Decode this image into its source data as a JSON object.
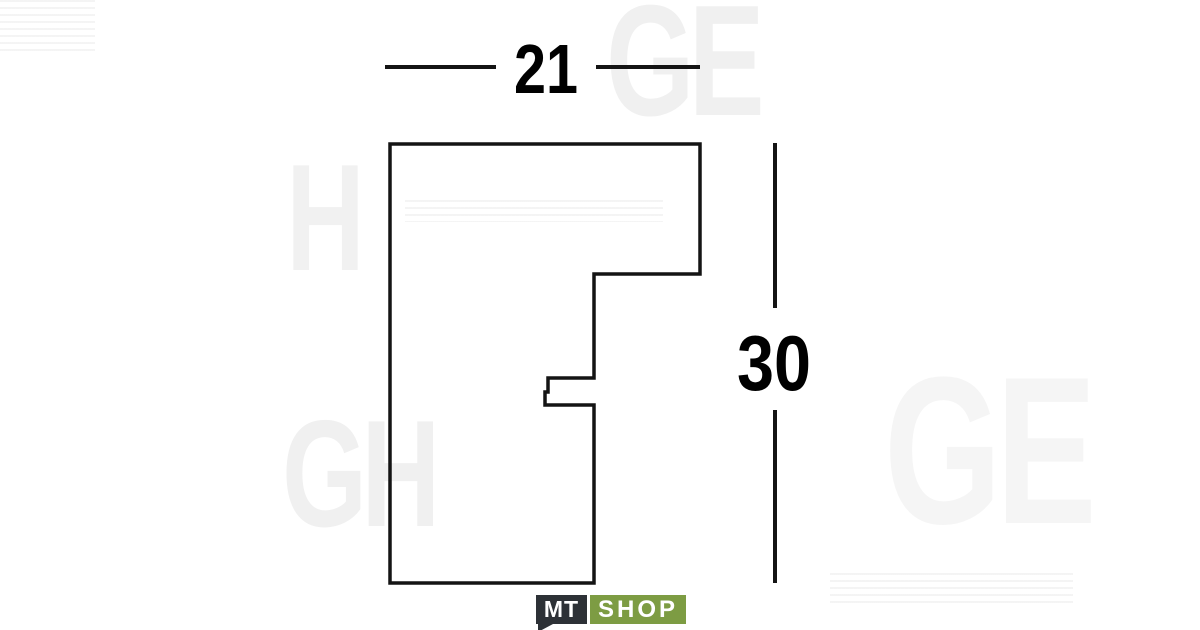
{
  "diagram": {
    "width_label": "21",
    "height_label": "30",
    "outline_color": "#141414",
    "profile_points": [
      [
        390,
        144
      ],
      [
        700,
        144
      ],
      [
        700,
        274
      ],
      [
        594,
        274
      ],
      [
        594,
        378
      ],
      [
        548,
        378
      ],
      [
        548,
        392
      ],
      [
        545,
        392
      ],
      [
        545,
        405
      ],
      [
        594,
        405
      ],
      [
        594,
        583
      ],
      [
        390,
        583
      ]
    ]
  },
  "watermark": {
    "fragments": [
      {
        "text": "GE"
      },
      {
        "text": "H"
      },
      {
        "text": "GH"
      },
      {
        "text": "GE"
      }
    ]
  },
  "logo": {
    "mt": "MT",
    "shop": "SHOP",
    "dark_color": "#2d3136",
    "green_color": "#7d9c43"
  }
}
